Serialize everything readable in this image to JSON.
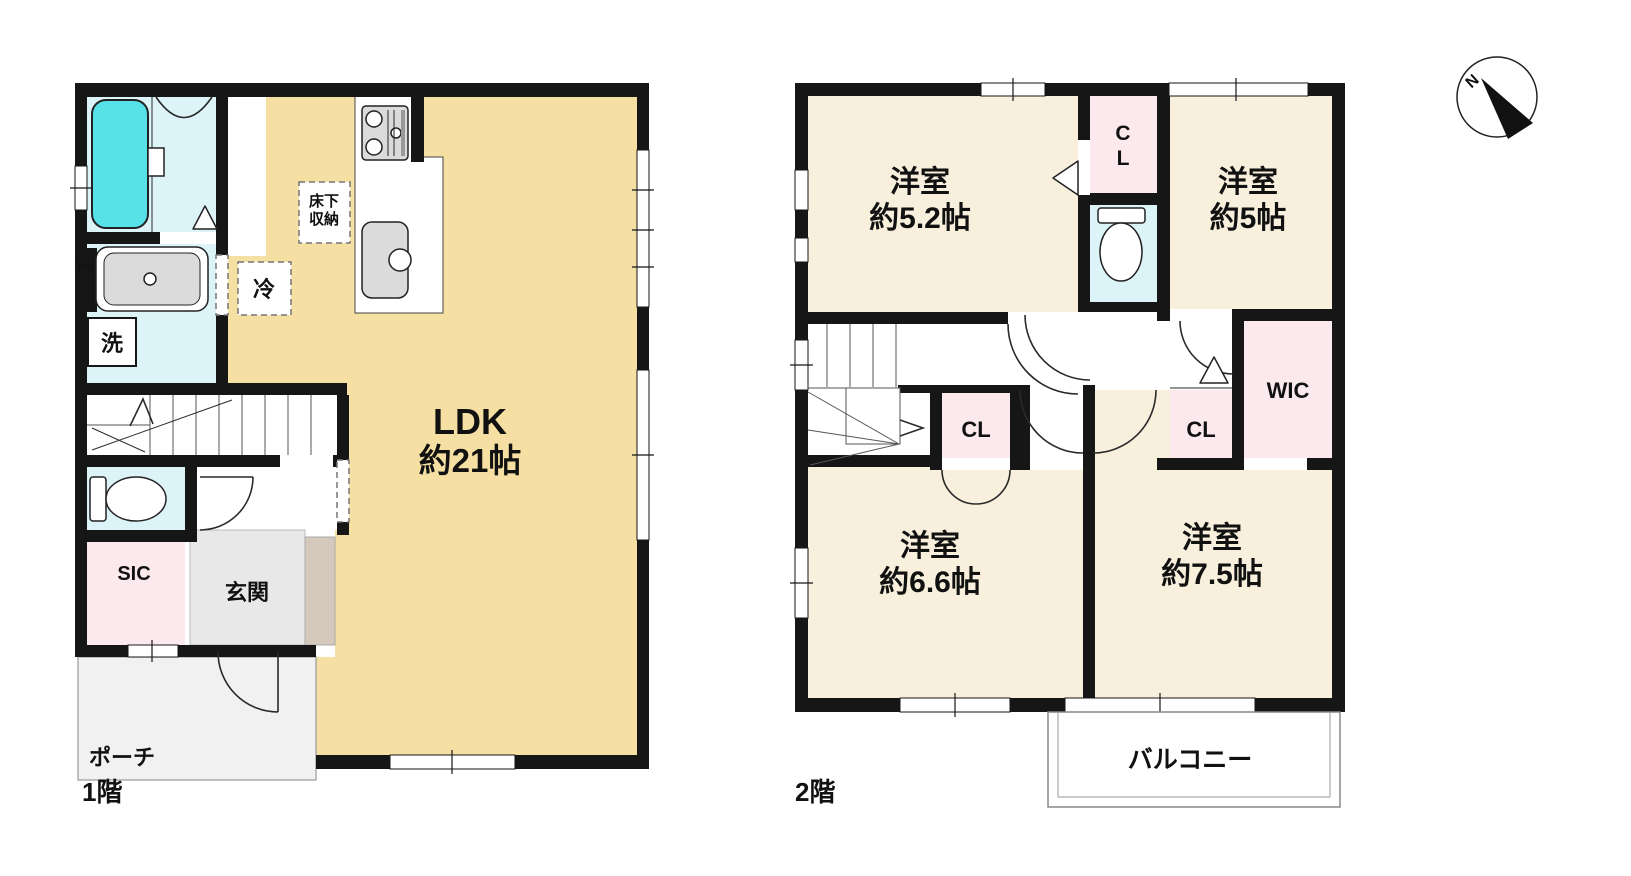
{
  "meta": {
    "title": "間取り図",
    "width": 1631,
    "height": 876
  },
  "colors": {
    "wall": "#161616",
    "ldk_fill": "#F6DFA3",
    "room_fill": "#F8F0DC",
    "closet_fill": "#FBE9ED",
    "wet_fill": "#DCF4F7",
    "bathtub_fill": "#57E1E8",
    "genkan_fill": "#E8E8E8",
    "step_fill": "#D5C9BD",
    "porch_fill": "#F1F1F1",
    "fixture_fill": "#DBDBDB"
  },
  "floor1": {
    "label": "1階",
    "ldk_name": "LDK",
    "ldk_size": "約21帖",
    "underfloor_line1": "床下",
    "underfloor_line2": "収納",
    "fridge": "冷",
    "laundry": "洗",
    "pipe_space": "PS",
    "shoe_closet": "SIC",
    "entrance": "玄関",
    "porch": "ポーチ"
  },
  "floor2": {
    "label": "2階",
    "room_52_name": "洋室",
    "room_52_size": "約5.2帖",
    "room_5_name": "洋室",
    "room_5_size": "約5帖",
    "room_66_name": "洋室",
    "room_66_size": "約6.6帖",
    "room_75_name": "洋室",
    "room_75_size": "約7.5帖",
    "closet_top_line1": "C",
    "closet_top_line2": "L",
    "closet_left": "CL",
    "closet_right": "CL",
    "walk_in_closet": "WIC",
    "balcony": "バルコニー"
  },
  "compass": {
    "north": "N"
  }
}
